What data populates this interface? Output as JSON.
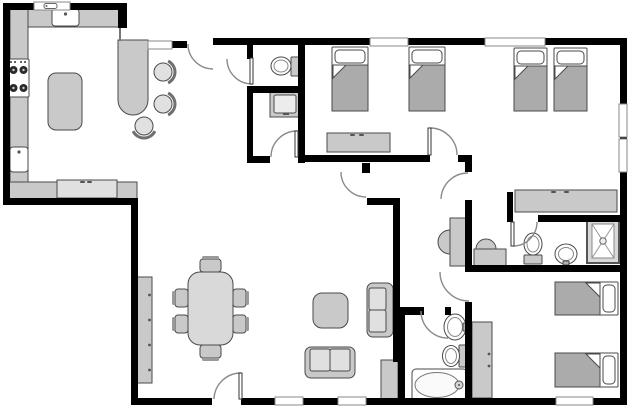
{
  "meta": {
    "type": "floor-plan",
    "canvas_w": 630,
    "canvas_h": 414,
    "bg": "#ffffff",
    "wall_color": "#000000",
    "stroke": "#4a4a4a",
    "fill": "#c9c9c9",
    "light": "#e0e0e0",
    "table_fill": "#d9d9d9",
    "blanket": "#ababab",
    "arc_color": "#8a8a8a"
  },
  "rooms": [
    {
      "n": "kitchen",
      "x": 10,
      "y": 10,
      "w": 205,
      "h": 186
    },
    {
      "n": "living-dining-room",
      "x": 138,
      "y": 162,
      "w": 255,
      "h": 236
    },
    {
      "n": "wc",
      "x": 253,
      "y": 45,
      "w": 45,
      "h": 41
    },
    {
      "n": "vanity-room",
      "x": 253,
      "y": 93,
      "w": 45,
      "h": 63
    },
    {
      "n": "bedroom-middle",
      "x": 305,
      "y": 45,
      "w": 160,
      "h": 110
    },
    {
      "n": "hallway",
      "x": 400,
      "y": 162,
      "w": 65,
      "h": 145
    },
    {
      "n": "bedroom-top-right",
      "x": 472,
      "y": 45,
      "w": 148,
      "h": 170
    },
    {
      "n": "ensuite-bathroom",
      "x": 513,
      "y": 222,
      "w": 107,
      "h": 43
    },
    {
      "n": "hall-bathroom",
      "x": 405,
      "y": 315,
      "w": 60,
      "h": 83
    },
    {
      "n": "bedroom-bottom-right",
      "x": 472,
      "y": 272,
      "w": 148,
      "h": 126
    }
  ],
  "walls": [
    [
      3,
      3,
      124,
      7,
      "wall-top-kitchen"
    ],
    [
      118,
      3,
      9,
      25,
      "wall-kitchen-column"
    ],
    [
      3,
      3,
      7,
      202,
      "wall-west-kitchen"
    ],
    [
      3,
      198,
      134,
      7,
      "wall-south-kitchen"
    ],
    [
      131,
      198,
      7,
      207,
      "wall-west-living"
    ],
    [
      131,
      398,
      496,
      7,
      "wall-south"
    ],
    [
      620,
      38,
      7,
      367,
      "wall-east"
    ],
    [
      213,
      38,
      414,
      7,
      "wall-top-main"
    ],
    [
      298,
      45,
      7,
      117,
      "wall-wc-east"
    ],
    [
      247,
      45,
      6,
      14,
      "wall-wc-stub"
    ],
    [
      247,
      86,
      58,
      7,
      "wall-wc-south"
    ],
    [
      247,
      86,
      6,
      77,
      "wall-vanityroom-west"
    ],
    [
      247,
      156,
      58,
      7,
      "wall-vanityroom-south"
    ],
    [
      305,
      155,
      167,
      7,
      "wall-bedroom-mid-south"
    ],
    [
      465,
      155,
      7,
      250,
      "wall-hall-east"
    ],
    [
      362,
      163,
      8,
      10,
      "wall-hall-stub"
    ],
    [
      367,
      198,
      33,
      7,
      "wall-hall-L-top"
    ],
    [
      393,
      198,
      7,
      164,
      "wall-hall-west"
    ],
    [
      398,
      307,
      26,
      8,
      "wall-bath-stub-west"
    ],
    [
      445,
      307,
      6,
      8,
      "wall-bath-stub-east"
    ],
    [
      398,
      307,
      7,
      93,
      "wall-bath-west"
    ],
    [
      507,
      192,
      6,
      30,
      "wall-ensuite-west-return"
    ],
    [
      507,
      215,
      120,
      7,
      "wall-ensuite-north"
    ],
    [
      465,
      265,
      162,
      7,
      "wall-br-bedroom-north"
    ],
    [
      172,
      41,
      15,
      7,
      "wall-bar-cap"
    ]
  ],
  "thin_lines": [
    [
      119,
      28,
      2,
      13,
      "bar-edge-line"
    ]
  ],
  "gaps": [
    [
      430,
      154,
      28,
      9,
      "doorway-bedroom-mid"
    ],
    [
      464,
      172,
      9,
      28,
      "doorway-bedroom-tr"
    ],
    [
      513,
      214,
      25,
      9,
      "doorway-ensuite"
    ],
    [
      464,
      272,
      9,
      30,
      "doorway-bedroom-br"
    ],
    [
      270,
      155,
      28,
      9,
      "doorway-vanity-room"
    ],
    [
      212,
      397,
      29,
      9,
      "doorway-front"
    ]
  ],
  "windows": [
    {
      "x": 34,
      "y": 2,
      "w": 36,
      "h": 8,
      "n": "window-kitchen",
      "glyph": true
    },
    {
      "x": 148,
      "y": 41,
      "w": 24,
      "h": 8,
      "n": "window-bar-pass"
    },
    {
      "x": 370,
      "y": 38,
      "w": 38,
      "h": 8,
      "n": "window-bedroom-mid"
    },
    {
      "x": 485,
      "y": 38,
      "w": 60,
      "h": 8,
      "n": "window-bedroom-tr"
    },
    {
      "x": 619,
      "y": 104,
      "w": 8,
      "h": 33,
      "n": "window-east-1"
    },
    {
      "x": 619,
      "y": 139,
      "w": 8,
      "h": 33,
      "n": "window-east-2"
    },
    {
      "x": 275,
      "y": 397,
      "w": 28,
      "h": 8,
      "n": "window-south-1"
    },
    {
      "x": 338,
      "y": 397,
      "w": 28,
      "h": 8,
      "n": "window-south-2"
    },
    {
      "x": 556,
      "y": 397,
      "w": 37,
      "h": 8,
      "n": "window-south-3"
    }
  ],
  "doors": [
    {
      "n": "kitchen-entry-door",
      "x1": 188,
      "y1": 44,
      "x2": 213,
      "y2": 69,
      "sweep": 0,
      "leaf": null
    },
    {
      "n": "wc-door",
      "x1": 227,
      "y1": 59,
      "x2": 252,
      "y2": 84,
      "sweep": 0,
      "leaf": [
        250,
        58,
        3,
        26
      ]
    },
    {
      "n": "vanity-room-door",
      "x1": 271,
      "y1": 157,
      "x2": 297,
      "y2": 131,
      "sweep": 1,
      "leaf": [
        295,
        131,
        3,
        26
      ]
    },
    {
      "n": "hall-door",
      "x1": 341,
      "y1": 172,
      "x2": 366,
      "y2": 197,
      "sweep": 0,
      "leaf": null
    },
    {
      "n": "bedroom-mid-door",
      "x1": 430,
      "y1": 128,
      "x2": 457,
      "y2": 155,
      "sweep": 1,
      "leaf": [
        428,
        128,
        3,
        27
      ]
    },
    {
      "n": "bedroom-tr-door",
      "x1": 441,
      "y1": 199,
      "x2": 468,
      "y2": 173,
      "sweep": 1,
      "leaf": null
    },
    {
      "n": "ensuite-door",
      "x1": 513,
      "y1": 246,
      "x2": 537,
      "y2": 222,
      "sweep": 0,
      "leaf": [
        511,
        222,
        3,
        24
      ]
    },
    {
      "n": "bedroom-br-door",
      "x1": 440,
      "y1": 272,
      "x2": 469,
      "y2": 301,
      "sweep": 0,
      "leaf": null
    },
    {
      "n": "hall-bath-door",
      "x1": 421,
      "y1": 311,
      "x2": 448,
      "y2": 338,
      "sweep": 0,
      "leaf": null
    },
    {
      "n": "front-door",
      "x1": 214,
      "y1": 399,
      "x2": 241,
      "y2": 373,
      "sweep": 1,
      "leaf": [
        239,
        373,
        3,
        26
      ]
    }
  ],
  "furniture": [
    {
      "k": "rect",
      "n": "kitchen-left-counter",
      "x": 10,
      "y": 8,
      "w": 18,
      "h": 175
    },
    {
      "k": "rect",
      "n": "kitchen-top-counter",
      "x": 28,
      "y": 8,
      "w": 95,
      "h": 19
    },
    {
      "k": "rect",
      "n": "kitchen-bottom-counter",
      "x": 7,
      "y": 182,
      "w": 130,
      "h": 17
    },
    {
      "k": "rect",
      "n": "dishwasher",
      "x": 57,
      "y": 180,
      "w": 60,
      "h": 18,
      "f": "light",
      "handles": [
        [
          80,
          181
        ],
        [
          87,
          181
        ]
      ]
    },
    {
      "k": "rrect",
      "n": "kitchen-island",
      "x": 48,
      "y": 73,
      "w": 34,
      "h": 57,
      "rx": 8
    },
    {
      "k": "bar",
      "n": "breakfast-bar",
      "x": 118,
      "y": 40,
      "w": 30,
      "h": 75
    },
    {
      "k": "sink",
      "n": "kitchen-top-sink",
      "x": 52,
      "y": 9,
      "w": 27,
      "h": 17
    },
    {
      "k": "sink",
      "n": "kitchen-left-sink",
      "x": 10,
      "y": 147,
      "w": 18,
      "h": 25
    },
    {
      "k": "stove",
      "n": "stove",
      "x": 8,
      "y": 59,
      "w": 21,
      "h": 38
    },
    {
      "k": "stool",
      "n": "bar-stool-1",
      "cx": 163,
      "cy": 72,
      "r": 9,
      "a": 0
    },
    {
      "k": "stool",
      "n": "bar-stool-2",
      "cx": 163,
      "cy": 104,
      "r": 9,
      "a": 0
    },
    {
      "k": "stool",
      "n": "bar-stool-3",
      "cx": 144,
      "cy": 126,
      "r": 9,
      "a": 90
    },
    {
      "k": "rect",
      "n": "sideboard",
      "x": 136,
      "y": 277,
      "w": 16,
      "h": 106,
      "dots": [
        [
          149.5,
          295
        ],
        [
          149.5,
          320
        ],
        [
          149.5,
          345
        ],
        [
          149.5,
          370
        ]
      ]
    },
    {
      "k": "rrect",
      "n": "dining-table",
      "x": 188,
      "y": 272,
      "w": 45,
      "h": 73,
      "rx": 12,
      "f": "table"
    },
    {
      "k": "chair",
      "n": "dining-chair-1",
      "x": 175,
      "y": 289,
      "w": 13,
      "h": 18,
      "side": "w"
    },
    {
      "k": "chair",
      "n": "dining-chair-2",
      "x": 175,
      "y": 315,
      "w": 13,
      "h": 18,
      "side": "w"
    },
    {
      "k": "chair",
      "n": "dining-chair-3",
      "x": 233,
      "y": 289,
      "w": 13,
      "h": 18,
      "side": "e"
    },
    {
      "k": "chair",
      "n": "dining-chair-4",
      "x": 233,
      "y": 315,
      "w": 13,
      "h": 18,
      "side": "e"
    },
    {
      "k": "chair",
      "n": "dining-chair-5",
      "x": 200,
      "y": 259,
      "w": 21,
      "h": 13,
      "side": "n"
    },
    {
      "k": "chair",
      "n": "dining-chair-6",
      "x": 200,
      "y": 345,
      "w": 21,
      "h": 13,
      "side": "s"
    },
    {
      "k": "rrect",
      "n": "side-table",
      "x": 313,
      "y": 293,
      "w": 35,
      "h": 35,
      "rx": 9
    },
    {
      "k": "sofa",
      "n": "loveseat",
      "x": 305,
      "y": 347,
      "w": 50,
      "h": 31,
      "back": "s"
    },
    {
      "k": "sofa",
      "n": "armchair-sofa",
      "x": 367,
      "y": 283,
      "w": 26,
      "h": 54,
      "back": "e"
    },
    {
      "k": "rect",
      "n": "storage-cabinet",
      "x": 381,
      "y": 360,
      "w": 17,
      "h": 39
    },
    {
      "k": "hvanity",
      "n": "hall-basin",
      "x": 450,
      "y": 218,
      "w": 17,
      "h": 48,
      "bulge": "w"
    },
    {
      "k": "hvanity",
      "n": "vestibule-basin",
      "x": 474,
      "y": 249,
      "w": 32,
      "h": 17,
      "bulge": "n"
    },
    {
      "k": "vanity",
      "n": "bath-vanity",
      "x": 270,
      "y": 91,
      "w": 31,
      "h": 26
    },
    {
      "k": "toilet",
      "n": "wc-toilet",
      "bx": 281,
      "by": 66,
      "rx": 10,
      "ry": 9,
      "tank": [
        291,
        57,
        9,
        19
      ]
    },
    {
      "k": "toilet",
      "n": "ensuite-toilet",
      "bx": 533,
      "by": 244,
      "rx": 9,
      "ry": 11,
      "tank": [
        524,
        255,
        18,
        9
      ]
    },
    {
      "k": "toilet",
      "n": "hallbath-toilet",
      "bx": 451,
      "by": 356,
      "rx": 8.5,
      "ry": 10.5,
      "tank": [
        459,
        345,
        7,
        22
      ]
    },
    {
      "k": "osink",
      "n": "pedestal-sink",
      "cx": 455,
      "cy": 327,
      "rx": 11,
      "ry": 13,
      "f": [
        463,
        323,
        5,
        8
      ]
    },
    {
      "k": "osink",
      "n": "ensuite-sink",
      "cx": 566,
      "cy": 254,
      "rx": 11,
      "ry": 10,
      "f": [
        563,
        261,
        6,
        4
      ]
    },
    {
      "k": "shower",
      "n": "shower",
      "x": 587,
      "y": 219,
      "w": 32,
      "h": 44
    },
    {
      "k": "tub",
      "n": "bathtub",
      "x": 412,
      "y": 369,
      "w": 55,
      "h": 32
    },
    {
      "k": "dresser",
      "n": "dresser-mid",
      "x": 327,
      "y": 133,
      "w": 63,
      "h": 19,
      "handles": [
        [
          350,
          134
        ],
        [
          359,
          134
        ]
      ]
    },
    {
      "k": "dresser",
      "n": "dresser-tr",
      "x": 515,
      "y": 190,
      "w": 102,
      "h": 22,
      "handles": [
        [
          551,
          191
        ],
        [
          564,
          191
        ]
      ]
    },
    {
      "k": "rect",
      "n": "wardrobe",
      "x": 472,
      "y": 322,
      "w": 20,
      "h": 76,
      "dots": [
        [
          489,
          354
        ],
        [
          489,
          366
        ]
      ]
    },
    {
      "k": "bedv",
      "n": "bed-mid-1",
      "x": 332,
      "y": 47,
      "w": 36,
      "h": 64
    },
    {
      "k": "bedv",
      "n": "bed-mid-2",
      "x": 409,
      "y": 47,
      "w": 36,
      "h": 64
    },
    {
      "k": "bedv",
      "n": "bed-tr-1",
      "x": 514,
      "y": 48,
      "w": 33,
      "h": 63
    },
    {
      "k": "bedv",
      "n": "bed-tr-2",
      "x": 554,
      "y": 48,
      "w": 33,
      "h": 63
    },
    {
      "k": "bedh",
      "n": "bed-br-1",
      "x": 555,
      "y": 282,
      "w": 63,
      "h": 33
    },
    {
      "k": "bedh",
      "n": "bed-br-2",
      "x": 555,
      "y": 353,
      "w": 63,
      "h": 34
    }
  ]
}
